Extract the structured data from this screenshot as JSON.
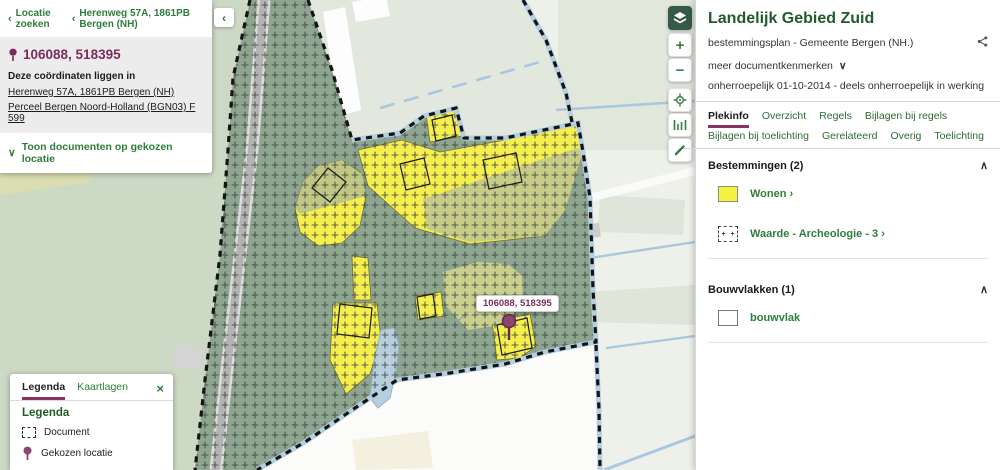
{
  "colors": {
    "accent_green": "#2e7d3a",
    "accent_maroon": "#7b2d5a",
    "wonen_yellow": "#f6f23f",
    "overlay_green": "#8ea58f"
  },
  "left_panel": {
    "breadcrumb": {
      "back": "Locatie zoeken",
      "location": "Herenweg 57A, 1861PB Bergen (NH)"
    },
    "coordinates": "106088, 518395",
    "intro": "Deze coördinaten liggen in",
    "link_address": "Herenweg 57A, 1861PB Bergen (NH)",
    "link_parcel": "Perceel Bergen Noord-Holland (BGN03) F 599",
    "toggle_documents": "Toon documenten op gekozen locatie",
    "collapse": "‹"
  },
  "legend_panel": {
    "tab_legenda": "Legenda",
    "tab_kaartlagen": "Kaartlagen",
    "close": "×",
    "heading": "Legenda",
    "item_document": "Document",
    "item_location": "Gekozen locatie"
  },
  "map": {
    "coordinate_label": "106088, 518395",
    "zoom_in": "+",
    "zoom_out": "−"
  },
  "right_panel": {
    "title": "Landelijk Gebied Zuid",
    "subtitle": "bestemmingsplan - Gemeente Bergen (NH.)",
    "more_documentkenmerken": "meer documentkenmerken",
    "status": "onherroepelijk 01-10-2014 - deels onherroepelijk in werking",
    "tabs": [
      "Plekinfo",
      "Overzicht",
      "Regels",
      "Bijlagen bij regels",
      "Bijlagen bij toelichting",
      "Gerelateerd",
      "Overig",
      "Toelichting"
    ],
    "active_tab": "Plekinfo",
    "bestemmingen": {
      "title": "Bestemmingen (2)",
      "wonen": "Wonen",
      "waarde": "Waarde - Archeologie - 3",
      "chevron": "›"
    },
    "bouwvlakken": {
      "title": "Bouwvlakken (1)",
      "bouwvlak": "bouwvlak"
    }
  }
}
